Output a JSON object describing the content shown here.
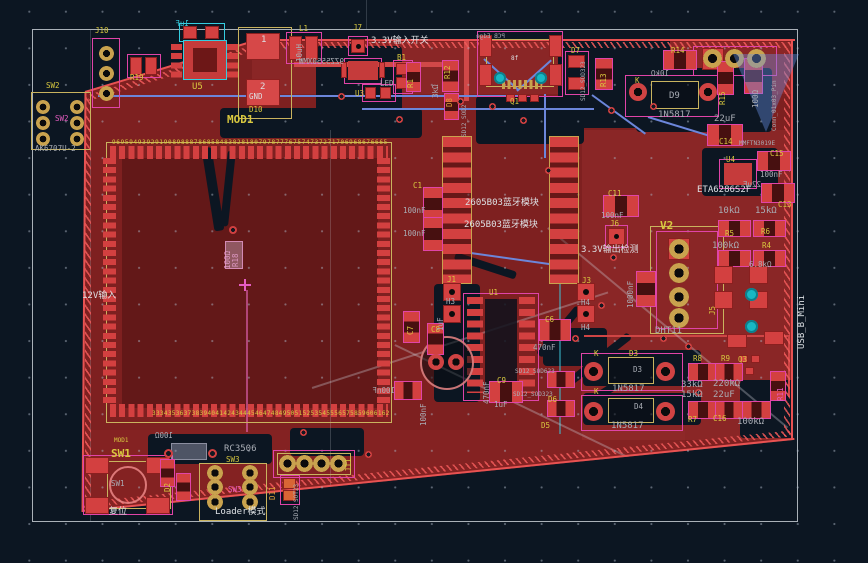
{
  "canvas": {
    "width": 868,
    "height": 563,
    "background": "#0c1622",
    "grid_dot_color": "#aab4c3"
  },
  "colors": {
    "zone_red": "#7e2020",
    "copper_pad": "#d34040",
    "board_edge": "#e85252",
    "silk_ref_yellow": "#d9c93f",
    "fab_value_grey": "#a9adb5",
    "silk_white": "#dde0e4",
    "courtyard_magenta": "#e044a8",
    "highlight_cyan": "#35cde0",
    "gold_hole": "#c9a24e",
    "blue_track": "#6c86da",
    "teal_via": "#17b8c4",
    "sheet_border": "#d2d8de"
  },
  "labels": [
    {
      "t": "J10"
    },
    {
      "t": "SW2"
    },
    {
      "t": "SW2"
    },
    {
      "t": "AK6707U-2"
    },
    {
      "t": "R19"
    },
    {
      "t": "U5"
    },
    {
      "t": "1uF"
    },
    {
      "t": "MOD1"
    },
    {
      "t": "1"
    },
    {
      "t": "2"
    },
    {
      "t": "GND"
    },
    {
      "t": "D10"
    },
    {
      "t": "9695949392919089888786858483828180797877767574737271706968676665"
    },
    {
      "t": "12V输入"
    },
    {
      "t": "MOD1"
    },
    {
      "t": "100Ω"
    },
    {
      "t": "SW1"
    },
    {
      "t": "SW1"
    },
    {
      "t": "复位"
    },
    {
      "t": "RC3506"
    },
    {
      "t": "SW3"
    },
    {
      "t": "SW3"
    },
    {
      "t": "Loader模式"
    },
    {
      "t": "L1"
    },
    {
      "t": "10uH"
    },
    {
      "t": "J7"
    },
    {
      "t": "3.3V输入开关"
    },
    {
      "t": "B1"
    },
    {
      "t": "9ZZ5550XMW"
    },
    {
      "t": "LED"
    },
    {
      "t": "U3"
    },
    {
      "t": "R1"
    },
    {
      "t": "R12"
    },
    {
      "t": "3kΩ"
    },
    {
      "t": "D8"
    },
    {
      "t": "SD12_SOD2"
    },
    {
      "t": "8f"
    },
    {
      "t": "Q1"
    },
    {
      "t": "PCB Edge"
    },
    {
      "t": "D7"
    },
    {
      "t": "SD12_SOD323"
    },
    {
      "t": "R13"
    },
    {
      "t": "R14"
    },
    {
      "t": "10kΩ"
    },
    {
      "t": "K"
    },
    {
      "t": "D9"
    },
    {
      "t": "1N5817"
    },
    {
      "t": "R15"
    },
    {
      "t": "100Ω"
    },
    {
      "t": "Conn_01x03_Pin"
    },
    {
      "t": "22uF"
    },
    {
      "t": "C14"
    },
    {
      "t": "MMFTN3019E"
    },
    {
      "t": "U4"
    },
    {
      "t": "ETA6286S2F"
    },
    {
      "t": "C15"
    },
    {
      "t": "100nF"
    },
    {
      "t": "22uF"
    },
    {
      "t": "C13"
    },
    {
      "t": "10kΩ"
    },
    {
      "t": "15kΩ"
    },
    {
      "t": "R5"
    },
    {
      "t": "R6"
    },
    {
      "t": "100kΩ"
    },
    {
      "t": "R4"
    },
    {
      "t": "6.8kΩ"
    },
    {
      "t": "J5"
    },
    {
      "t": "USB_B_Mini"
    },
    {
      "t": "C11"
    },
    {
      "t": "100nF"
    },
    {
      "t": "J6"
    },
    {
      "t": "3.3V输出检测"
    },
    {
      "t": "V2"
    },
    {
      "t": "DHT11"
    },
    {
      "t": "1000nF"
    },
    {
      "t": "C1"
    },
    {
      "t": "100nF"
    },
    {
      "t": "100nF"
    },
    {
      "t": "2605B03蓝牙模块"
    },
    {
      "t": "2605B03蓝牙模块"
    },
    {
      "t": "U1"
    },
    {
      "t": "J1"
    },
    {
      "t": "H3"
    },
    {
      "t": "J3"
    },
    {
      "t": "H4"
    },
    {
      "t": "H4"
    },
    {
      "t": "C6"
    },
    {
      "t": "470nF"
    },
    {
      "t": "C9"
    },
    {
      "t": "1uF"
    },
    {
      "t": "470nF"
    },
    {
      "t": "100nF"
    },
    {
      "t": "C7"
    },
    {
      "t": "C8"
    },
    {
      "t": "1uF"
    },
    {
      "t": "100nF"
    },
    {
      "t": "SD12_SOD623"
    },
    {
      "t": "SD12_SOD323"
    },
    {
      "t": "D6"
    },
    {
      "t": "D5"
    },
    {
      "t": "K"
    },
    {
      "t": "D3"
    },
    {
      "t": "D3"
    },
    {
      "t": "1N5817"
    },
    {
      "t": "K"
    },
    {
      "t": "D4"
    },
    {
      "t": "1N5817"
    },
    {
      "t": "R8"
    },
    {
      "t": "R9"
    },
    {
      "t": "33kΩ"
    },
    {
      "t": "220kΩ"
    },
    {
      "t": "15kΩ"
    },
    {
      "t": "22uF"
    },
    {
      "t": "R7"
    },
    {
      "t": "C16"
    },
    {
      "t": "100kΩ"
    },
    {
      "t": "Q3"
    },
    {
      "t": "R11"
    },
    {
      "t": "333435363738394041424344454647484950515253545556575859606162"
    },
    {
      "t": "R18"
    },
    {
      "t": "100Ω"
    },
    {
      "t": "D2"
    },
    {
      "t": "D11"
    },
    {
      "t": "SD12_SOT23"
    },
    {
      "t": "J11"
    }
  ]
}
